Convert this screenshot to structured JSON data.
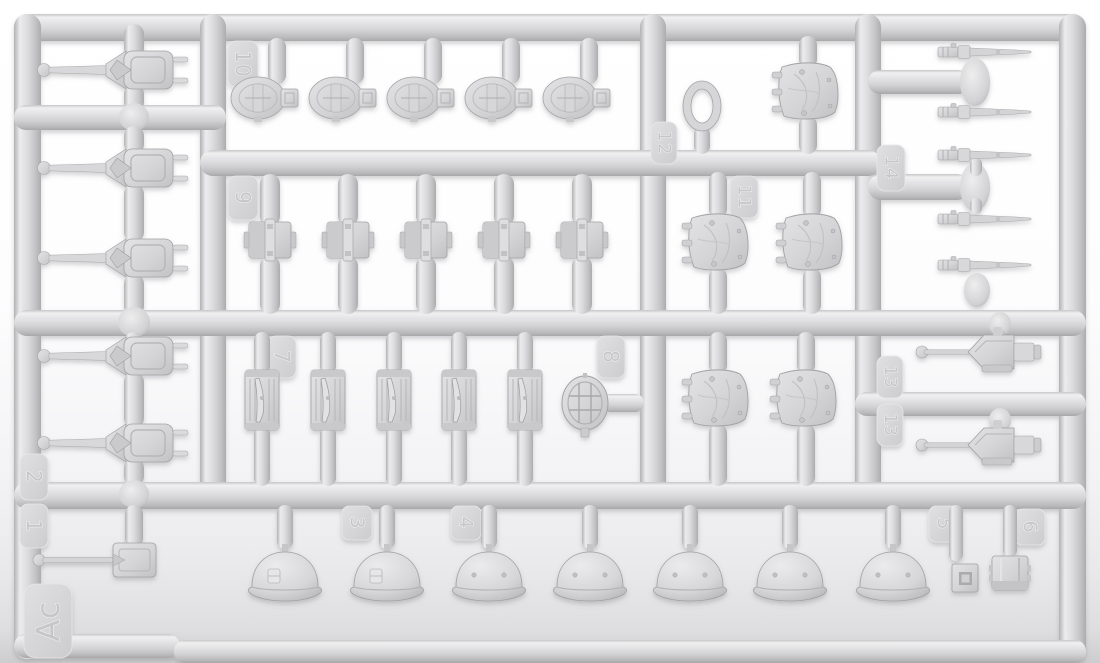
{
  "scene": {
    "subject": "injection-molded plastic model kit sprue",
    "sprue_frame_id": "Ac",
    "plastic_color": "#d6d6d8",
    "plastic_highlight": "#f0f0f1",
    "plastic_shadow": "#aaaaac",
    "background_top": "#ffffff",
    "background_bottom": "#cdcdcf"
  },
  "labels": {
    "n1": "1",
    "n2": "2",
    "n3": "3",
    "n4": "4",
    "n5": "5",
    "n6": "6",
    "n7": "7",
    "n8": "8",
    "n9": "9",
    "n10": "10",
    "n11": "11",
    "n12": "12",
    "n13": "13",
    "n14": "14",
    "ac": "Ac"
  },
  "part_groups": [
    {
      "number": "1",
      "content": "gun shield plate with ball-tipped barrel",
      "count": 1
    },
    {
      "number": "2",
      "content": "small turret with long gun barrel",
      "count": 5
    },
    {
      "number": "3",
      "content": "stahlhelm helmet with side shield insignia",
      "count": 2
    },
    {
      "number": "4",
      "content": "stahlhelm helmet plain",
      "count": 5
    },
    {
      "number": "5",
      "content": "small square fitting",
      "count": 1
    },
    {
      "number": "6",
      "content": "drum canister",
      "count": 1
    },
    {
      "number": "7",
      "content": "rifle in rectangular carrier frame",
      "count": 5
    },
    {
      "number": "8",
      "content": "round grilled hatch",
      "count": 1
    },
    {
      "number": "9",
      "content": "gun breech block",
      "count": 5
    },
    {
      "number": "10",
      "content": "oval gun mantlet with bracket",
      "count": 5
    },
    {
      "number": "11",
      "content": "stowage-covered turret shell",
      "count": 5
    },
    {
      "number": "12",
      "content": "oval hatch ring",
      "count": 1
    },
    {
      "number": "13",
      "content": "gun mount with thin ball-tipped barrel",
      "count": 2
    },
    {
      "number": "14",
      "content": "tapered gun barrel with breech",
      "count": 5
    }
  ]
}
